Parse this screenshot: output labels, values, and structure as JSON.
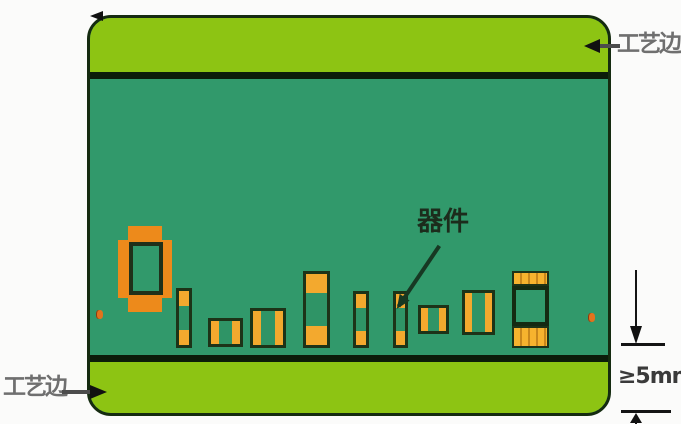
{
  "page": {
    "background": "#fbfbfa"
  },
  "board": {
    "rail_color": "#8dc413",
    "body_color": "#31996b",
    "outline_color": "#152b10",
    "separator_color": "#0c1c0a",
    "pad_orange": "#f3a92e",
    "large_pad_orange": "#ed8a1b"
  },
  "labels": {
    "process_edge_top": "工艺边",
    "process_edge_bottom": "工艺边",
    "component": "器件",
    "dimension": "≥5mm"
  },
  "diagram": {
    "description_components": [
      {
        "kind": "plus-pad",
        "x": 118,
        "y": 226,
        "w": 54,
        "h": 86
      },
      {
        "kind": "chip-v",
        "x": 176,
        "y": 288,
        "w": 16,
        "h": 60
      },
      {
        "kind": "chip-h",
        "x": 208,
        "y": 318,
        "w": 35,
        "h": 29
      },
      {
        "kind": "chip-h",
        "x": 250,
        "y": 308,
        "w": 36,
        "h": 40
      },
      {
        "kind": "chip-v",
        "x": 303,
        "y": 271,
        "w": 27,
        "h": 77
      },
      {
        "kind": "chip-v",
        "x": 353,
        "y": 291,
        "w": 16,
        "h": 57
      },
      {
        "kind": "chip-v",
        "x": 393,
        "y": 291,
        "w": 15,
        "h": 57
      },
      {
        "kind": "chip-h",
        "x": 418,
        "y": 305,
        "w": 31,
        "h": 29
      },
      {
        "kind": "chip-h",
        "x": 462,
        "y": 290,
        "w": 33,
        "h": 45
      },
      {
        "kind": "ic",
        "x": 512,
        "y": 271,
        "w": 37,
        "h": 77,
        "pads_top_h": 15,
        "body_h": 40,
        "pads_bottom_h": 22
      }
    ],
    "fiducials": [
      {
        "x": 96,
        "y": 310
      },
      {
        "x": 588,
        "y": 313
      }
    ]
  }
}
